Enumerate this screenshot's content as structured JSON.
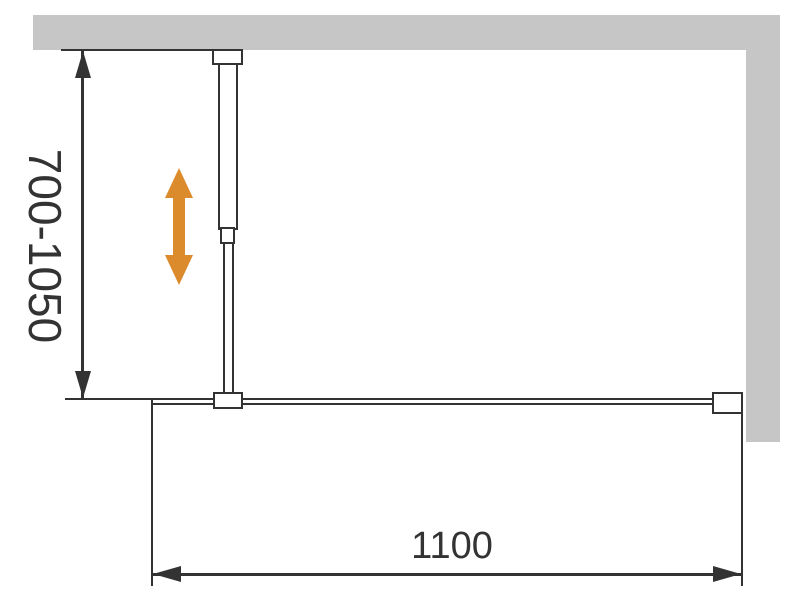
{
  "diagram": {
    "vertical_dimension_label": "700-1050",
    "horizontal_dimension_label": "1100",
    "adjust_arrow_icon": "double-headed-vertical-arrow",
    "colors": {
      "wall": "#c6c6c6",
      "line": "#333333",
      "accent": "#dc8b2c",
      "background": "#ffffff"
    }
  }
}
